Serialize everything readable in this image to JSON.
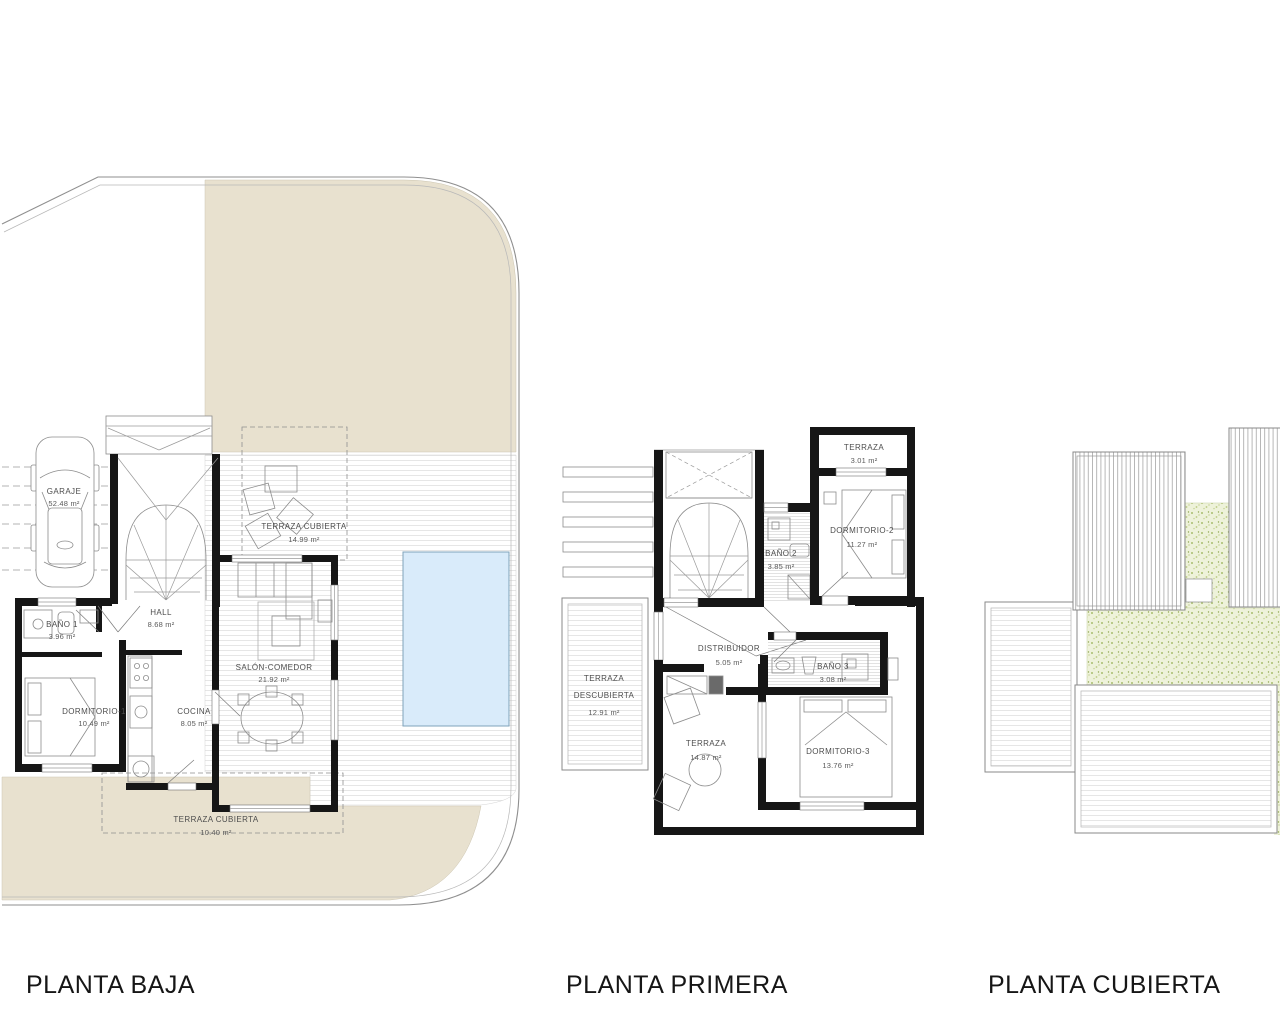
{
  "titles": {
    "baja": "PLANTA BAJA",
    "primera": "PLANTA PRIMERA",
    "cubierta": "PLANTA CUBIERTA"
  },
  "colors": {
    "sand": "#e8e1cf",
    "pool": "#d9ebfa",
    "grass_base": "#eef2da",
    "wall": "#161616"
  },
  "plans": {
    "baja": {
      "rooms": [
        {
          "name": "GARAJE",
          "area": "52.48 m²"
        },
        {
          "name": "BAÑO 1",
          "area": "3.96 m²"
        },
        {
          "name": "HALL",
          "area": "8.68 m²"
        },
        {
          "name": "DORMITORIO-1",
          "area": "10.49 m²"
        },
        {
          "name": "COCINA",
          "area": "8.05 m²"
        },
        {
          "name": "SALÓN-COMEDOR",
          "area": "21.92 m²"
        },
        {
          "name": "TERRAZA CUBIERTA",
          "area": "14.99 m²"
        },
        {
          "name": "TERRAZA CUBIERTA",
          "area": "10.40 m²"
        }
      ]
    },
    "primera": {
      "rooms": [
        {
          "name": "TERRAZA",
          "area": "3.01 m²"
        },
        {
          "name": "DORMITORIO-2",
          "area": "11.27 m²"
        },
        {
          "name": "BAÑO 2",
          "area": "3.85 m²"
        },
        {
          "name": "DISTRIBUIDOR",
          "area": "5.05 m²"
        },
        {
          "name": "BAÑO 3",
          "area": "3.08 m²"
        },
        {
          "name_line1": "TERRAZA",
          "name_line2": "DESCUBIERTA",
          "area": "12.91 m²"
        },
        {
          "name": "TERRAZA",
          "area": "14.87 m²"
        },
        {
          "name": "DORMITORIO-3",
          "area": "13.76 m²"
        }
      ]
    },
    "cubierta": {
      "rooms": []
    }
  }
}
